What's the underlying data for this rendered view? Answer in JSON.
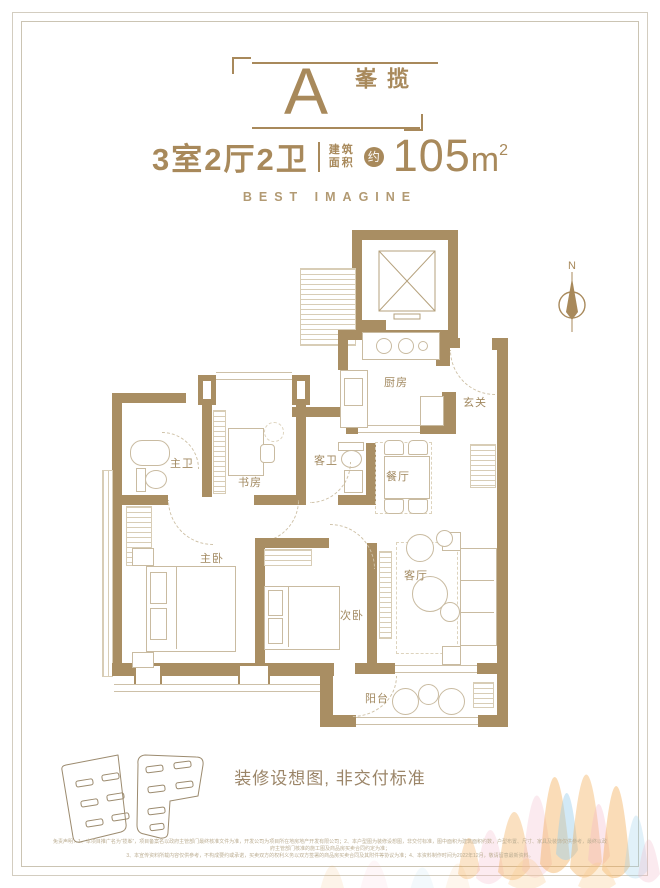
{
  "header": {
    "unit_label": "A",
    "unit_name": "揽峯",
    "spec": "3室2厅2卫",
    "area_label_line1": "建筑",
    "area_label_line2": "面积",
    "area_approx": "约",
    "area_value": "105",
    "area_unit": "m",
    "area_exponent": "2",
    "tagline": "BEST IMAGINE"
  },
  "plan": {
    "compass_label": "N",
    "rooms": [
      {
        "id": "kitchen",
        "label": "厨房"
      },
      {
        "id": "foyer",
        "label": "玄关"
      },
      {
        "id": "master-bath",
        "label": "主卫"
      },
      {
        "id": "study",
        "label": "书房"
      },
      {
        "id": "guest-bath",
        "label": "客卫"
      },
      {
        "id": "dining",
        "label": "餐厅"
      },
      {
        "id": "master-bedroom",
        "label": "主卧"
      },
      {
        "id": "second-bedroom",
        "label": "次卧"
      },
      {
        "id": "living",
        "label": "客厅"
      },
      {
        "id": "balcony",
        "label": "阳台"
      }
    ]
  },
  "footer": {
    "caption": "装修设想图, 非交付标准",
    "disclaimer_line1": "免责声明：1、本项目推广名为“揽峯”，项目备案名以政府主管部门最终核准文件为准，开发公司为项目所在地房地产开发有限公司；2、本户型图为装修设想图，非交付标准，图中面积为建筑面积约数，户型布置、尺寸、家具及装饰仅供参考，最终以政府主管部门核准的施工图及商品房买卖合同约定为准；",
    "disclaimer_line2": "3、本宣传资料所载内容仅供参考，不构成要约或承诺，买卖双方的权利义务以双方签署的商品房买卖合同及其附件等协议为准；4、本资料制作时间为2022年12月，敬请留意最新资料。"
  },
  "colors": {
    "accent_gold": "#a8895b",
    "wall_tan": "#a98e63",
    "furniture_line": "#c9bba1",
    "watercolor_orange": "#f2a74b",
    "watercolor_blue": "#9ccfea",
    "watercolor_pink": "#f3b8c9"
  }
}
